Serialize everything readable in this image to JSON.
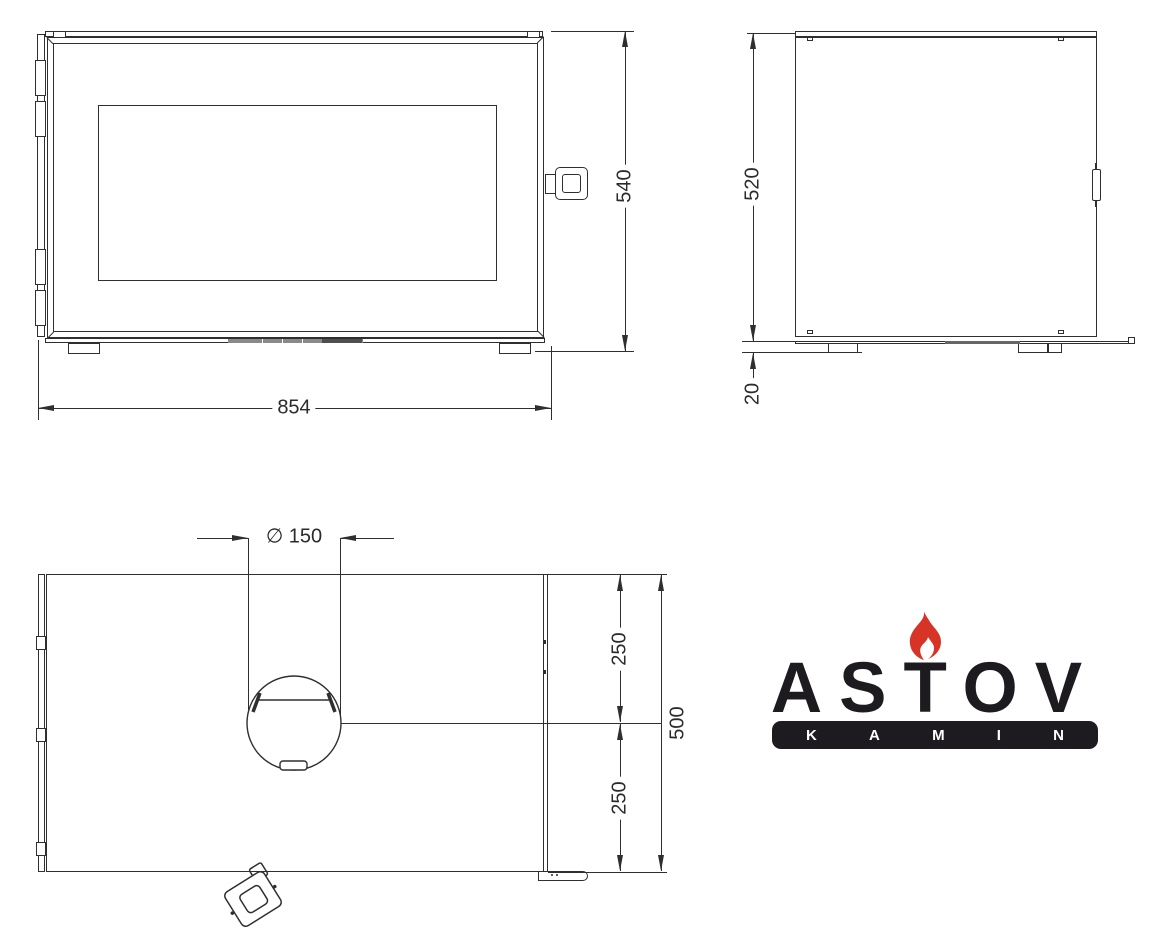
{
  "colors": {
    "line": "#2f2f2f",
    "dimension_text": "#2b2b2b",
    "logo_black": "#1e1b20",
    "flame_red": "#d63427",
    "background": "#ffffff"
  },
  "front_view": {
    "dim_width": "854",
    "dim_height": "540"
  },
  "side_view": {
    "dim_depth": "520",
    "dim_floor_gap": "20"
  },
  "top_view": {
    "dim_flue_diameter": "∅ 150",
    "dim_flue_center_to_back": "250",
    "dim_flue_center_to_front": "250",
    "dim_total_depth": "500"
  },
  "logo": {
    "brand": "ASTOV",
    "subbrand": "KAMIN",
    "kamin_letters": [
      "K",
      "A",
      "M",
      "I",
      "N"
    ]
  }
}
